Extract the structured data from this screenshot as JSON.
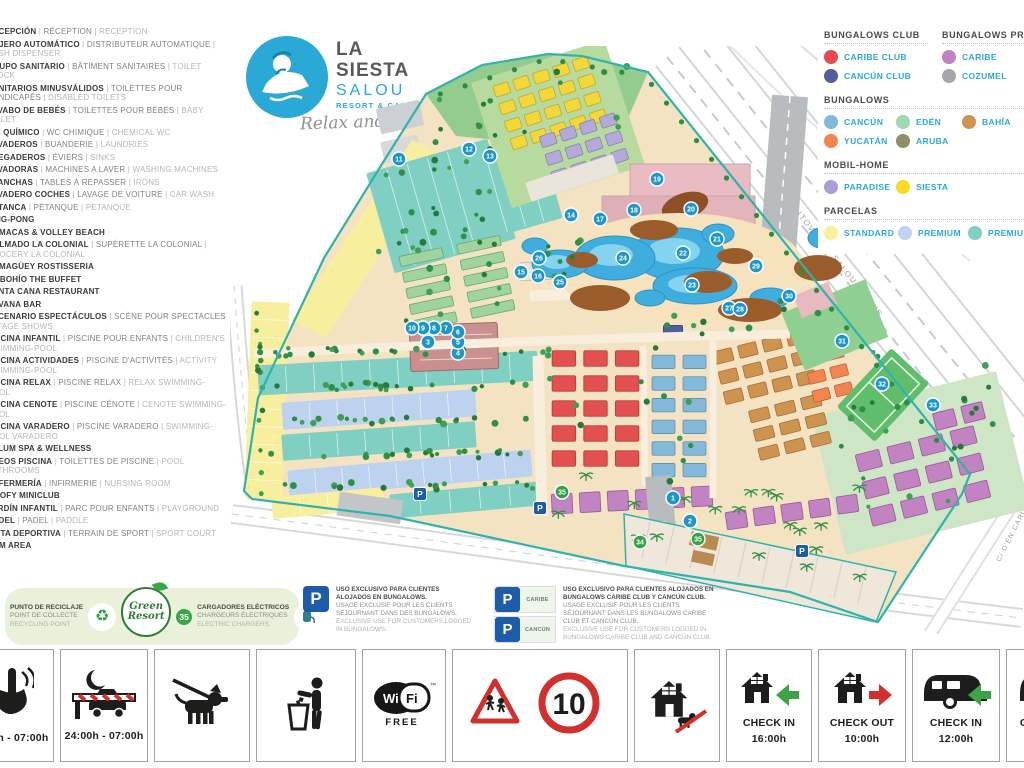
{
  "logo": {
    "line1": "LA",
    "line2": "SIESTA",
    "line3": "SALOU",
    "line4": "RESORT & CAMPING",
    "tagline": "Relax and Enjoy"
  },
  "sidebar": {
    "items": [
      {
        "es": "RECEPCIÓN",
        "fr": "RÉCEPTION",
        "en": "RECEPTION"
      },
      {
        "es": "CAJERO AUTOMÁTICO",
        "fr": "DISTRIBUTEUR AUTOMATIQUE",
        "en": "CASH DISPENSER"
      },
      {
        "es": "GRUPO SANITARIO",
        "fr": "BÂTIMENT SANITAIRES",
        "en": "TOILET BLOCK"
      },
      {
        "es": "SANITARIOS MINUSVÁLIDOS",
        "fr": "TOILETTES POUR HANDICAPÉS",
        "en": "DISABLED TOILETS"
      },
      {
        "es": "LAVABO DE BEBÉS",
        "fr": "TOILETTES POUR BÉBÉS",
        "en": "BABY TOILET"
      },
      {
        "es": "WC QUÍMICO",
        "fr": "WC CHIMIQUE",
        "en": "CHEMICAL WC"
      },
      {
        "es": "LAVADEROS",
        "fr": "BUANDERIE",
        "en": "LAUNDRIES"
      },
      {
        "es": "FREGADEROS",
        "fr": "ÉVIERS",
        "en": "SINKS"
      },
      {
        "es": "LAVADORAS",
        "fr": "MACHINES A LAVER",
        "en": "WASHING MACHINES"
      },
      {
        "es": "PLANCHAS",
        "fr": "TABLES À REPASSER",
        "en": "IRONS"
      },
      {
        "es": "LAVADERO COCHES",
        "fr": "LAVAGE DE VOITURE",
        "en": "CAR WASH"
      },
      {
        "es": "PETANCA",
        "fr": "PÉTANQUE",
        "en": "PETANQUE"
      },
      {
        "es": "PING-PONG"
      },
      {
        "es": "HAMACAS & VOLLEY BEACH"
      },
      {
        "es": "COLMADO LA COLONIAL",
        "fr": "SUPÉRETTE LA COLONIAL",
        "en": "GROCERY LA COLONIAL"
      },
      {
        "es": "CAMAGÜEY ROSTISSERIA"
      },
      {
        "es": "EL BOHÍO THE BUFFET"
      },
      {
        "es": "PUNTA CANA RESTAURANT"
      },
      {
        "es": "HAVANA BAR"
      },
      {
        "es": "ESCENARIO ESPECTÁCULOS",
        "fr": "SCÈNE POUR SPECTACLES",
        "en": "STAGE SHOWS"
      },
      {
        "es": "PISCINA INFANTIL",
        "fr": "PISCINE POUR ENFANTS",
        "en": "CHILDREN'S SWIMMING-POOL"
      },
      {
        "es": "PISCINA ACTIVIDADES",
        "fr": "PISCINE D'ACTIVITÉS",
        "en": "ACTIVITY SWIMMING-POOL"
      },
      {
        "es": "PISCINA RELAX",
        "fr": "PISCINE RELAX",
        "en": "RELAX SWIMMING-POOL"
      },
      {
        "es": "PISCINA CENOTE",
        "fr": "PISCINE CÉNOTE",
        "en": "CENOTE SWIMMING-POOL"
      },
      {
        "es": "PISCINA VARADERO",
        "fr": "PISCINE VARADERO",
        "en": "SWIMMING-POOL VARADERO"
      },
      {
        "es": "TULUM SPA & WELLNESS"
      },
      {
        "es": "ASEOS PISCINA",
        "fr": "TOILETTES DE PISCINE",
        "en": "POOL BATHROOMS"
      },
      {
        "es": "ENFERMERÍA",
        "fr": "INFIRMERIE",
        "en": "NURSING ROOM"
      },
      {
        "es": "GOOFY MINICLUB"
      },
      {
        "es": "JARDÍN INFANTIL",
        "fr": "PARC POUR ENFANTS",
        "en": "PLAYGROUND"
      },
      {
        "es": "PÁDEL",
        "fr": "PADEL",
        "en": "PADDLE"
      },
      {
        "es": "PISTA DEPORTIVA",
        "fr": "TERRAIN DE SPORT",
        "en": "SPORT COURT"
      },
      {
        "es": "GYM AREA"
      }
    ]
  },
  "legend": {
    "rows": [
      {
        "columns": [
          {
            "title": "BUNGALOWS CLUB",
            "items": [
              {
                "label": "CARIBE CLUB",
                "color": "#e8484e"
              },
              {
                "label": "CANCÚN CLUB",
                "color": "#4f5e9c"
              }
            ]
          },
          {
            "title": "BUNGALOWS PREMIUM",
            "items": [
              {
                "label": "CARIBE",
                "color": "#c27fc2"
              },
              {
                "label": "COZUMEL",
                "color": "#a7a3af"
              }
            ]
          }
        ]
      },
      {
        "columns": [
          {
            "title": "BUNGALOWS",
            "grid": "72px 66px auto",
            "items": [
              {
                "label": "CANCÚN",
                "color": "#7fb8d9"
              },
              {
                "label": "EDÉN",
                "color": "#9ed8b2"
              },
              {
                "label": "BAHÍA",
                "color": "#cf9350"
              },
              {
                "label": "YUCATÁN",
                "color": "#f2854f"
              },
              {
                "label": "ARUBA",
                "color": "#8f8f66"
              }
            ]
          }
        ]
      },
      {
        "columns": [
          {
            "title": "MOBIL-HOME",
            "grid": "72px 66px auto",
            "items": [
              {
                "label": "PARADISE",
                "color": "#a79fd6"
              },
              {
                "label": "SIESTA",
                "color": "#f8da22"
              }
            ]
          }
        ]
      },
      {
        "columns": [
          {
            "title": "PARCELAS",
            "grid": "74px 70px auto",
            "items": [
              {
                "label": "STANDARD",
                "color": "#f9f099"
              },
              {
                "label": "PREMIUM",
                "color": "#bdd2ef"
              },
              {
                "label": "PREMIUM PLUS",
                "color": "#7fcfc2"
              }
            ]
          }
        ]
      }
    ]
  },
  "map": {
    "streets": {
      "autovia": "AUTOVÍA DE SALOU A REUS",
      "berlin": "C/ DE BERLIN",
      "nord": "C/ DEL NORD",
      "carles": "C/ D'EN CARLES BUIGAS"
    },
    "markers": [
      {
        "n": "1",
        "t": "b",
        "x": 443,
        "y": 452
      },
      {
        "n": "2",
        "t": "b",
        "x": 460,
        "y": 475
      },
      {
        "n": "3",
        "t": "b",
        "x": 198,
        "y": 296
      },
      {
        "n": "4",
        "t": "b",
        "x": 228,
        "y": 307
      },
      {
        "n": "5",
        "t": "b",
        "x": 228,
        "y": 296
      },
      {
        "n": "6",
        "t": "b",
        "x": 228,
        "y": 286
      },
      {
        "n": "7",
        "t": "b",
        "x": 216,
        "y": 282
      },
      {
        "n": "8",
        "t": "b",
        "x": 204,
        "y": 282
      },
      {
        "n": "9",
        "t": "b",
        "x": 193,
        "y": 282
      },
      {
        "n": "10",
        "t": "b",
        "x": 182,
        "y": 282
      },
      {
        "n": "11",
        "t": "b",
        "x": 169,
        "y": 113
      },
      {
        "n": "12",
        "t": "b",
        "x": 239,
        "y": 103
      },
      {
        "n": "13",
        "t": "b",
        "x": 260,
        "y": 110
      },
      {
        "n": "14",
        "t": "b",
        "x": 341,
        "y": 169
      },
      {
        "n": "15",
        "t": "b",
        "x": 291,
        "y": 226
      },
      {
        "n": "16",
        "t": "b",
        "x": 308,
        "y": 230
      },
      {
        "n": "17",
        "t": "b",
        "x": 370,
        "y": 173
      },
      {
        "n": "18",
        "t": "b",
        "x": 404,
        "y": 164
      },
      {
        "n": "19",
        "t": "b",
        "x": 427,
        "y": 133
      },
      {
        "n": "20",
        "t": "b",
        "x": 461,
        "y": 163
      },
      {
        "n": "21",
        "t": "b",
        "x": 487,
        "y": 193
      },
      {
        "n": "22",
        "t": "b",
        "x": 453,
        "y": 207
      },
      {
        "n": "23",
        "t": "b",
        "x": 462,
        "y": 239
      },
      {
        "n": "24",
        "t": "b",
        "x": 393,
        "y": 212
      },
      {
        "n": "25",
        "t": "b",
        "x": 330,
        "y": 236
      },
      {
        "n": "26",
        "t": "b",
        "x": 309,
        "y": 212
      },
      {
        "n": "27",
        "t": "b",
        "x": 499,
        "y": 262
      },
      {
        "n": "28",
        "t": "b",
        "x": 510,
        "y": 263
      },
      {
        "n": "29",
        "t": "b",
        "x": 526,
        "y": 220
      },
      {
        "n": "30",
        "t": "b",
        "x": 559,
        "y": 250
      },
      {
        "n": "31",
        "t": "b",
        "x": 612,
        "y": 295
      },
      {
        "n": "32",
        "t": "b",
        "x": 652,
        "y": 338
      },
      {
        "n": "33",
        "t": "b",
        "x": 703,
        "y": 359
      },
      {
        "n": "34",
        "t": "g",
        "x": 410,
        "y": 496
      },
      {
        "n": "35",
        "t": "g",
        "x": 468,
        "y": 493
      },
      {
        "n": "35",
        "t": "g",
        "x": 332,
        "y": 446
      },
      {
        "n": "P",
        "t": "p",
        "x": 190,
        "y": 448
      },
      {
        "n": "P",
        "t": "p",
        "x": 310,
        "y": 462
      },
      {
        "n": "P",
        "t": "p",
        "x": 572,
        "y": 505
      }
    ],
    "zones": [
      {
        "t": "p",
        "d": "M196,48 L252,19 L318,8 L352,10 L418,26 L392,86 L300,97 L226,90 Z",
        "fill": "#94cb8e"
      },
      {
        "t": "r",
        "x": 148,
        "y": 58,
        "w": 44,
        "h": 26,
        "rot": -12,
        "fill": "#ccd0d4"
      },
      {
        "t": "r",
        "x": 152,
        "y": 92,
        "w": 38,
        "h": 22,
        "rot": -12,
        "fill": "#d9d9d5"
      },
      {
        "t": "p",
        "d": "M182,94 L214,108 L96,292 L62,274 Z",
        "fill": "#f7ef9e"
      },
      {
        "t": "pb",
        "x": 18,
        "y": 256,
        "w": 38,
        "h": 196,
        "rot": 2,
        "fill": "#f7ef9e",
        "divs": 11,
        "horiz": true
      },
      {
        "t": "pb",
        "x": 148,
        "y": 108,
        "w": 126,
        "h": 104,
        "rot": -16,
        "fill": "#7fcfc2",
        "divs": 6
      },
      {
        "t": "pb",
        "x": 246,
        "y": 96,
        "w": 76,
        "h": 88,
        "rot": -16,
        "fill": "#7fcfc2",
        "divs": 4
      },
      {
        "t": "g",
        "x": 168,
        "y": 196,
        "w": 118,
        "h": 82,
        "rot": -12,
        "rows": 5,
        "cols": 2,
        "fill": "#9fd3a0",
        "stroke": "#6aa86c"
      },
      {
        "t": "r",
        "x": 258,
        "y": 12,
        "w": 140,
        "h": 132,
        "rot": -18,
        "fill": "#b7da9e"
      },
      {
        "t": "g",
        "x": 268,
        "y": 20,
        "w": 104,
        "h": 74,
        "rot": -18,
        "rows": 4,
        "cols": 5,
        "fill": "#f3d83a",
        "stroke": "#c9a42c"
      },
      {
        "t": "g",
        "x": 312,
        "y": 74,
        "w": 84,
        "h": 56,
        "rot": -18,
        "rows": 3,
        "cols": 4,
        "fill": "#b3aad9",
        "stroke": "#8a7fb8"
      },
      {
        "t": "r",
        "x": 296,
        "y": 122,
        "w": 92,
        "h": 20,
        "rot": -18,
        "fill": "#e9e5da"
      },
      {
        "t": "pb",
        "x": 28,
        "y": 312,
        "w": 280,
        "h": 30,
        "rot": -3,
        "fill": "#7fcfc2",
        "divs": 10
      },
      {
        "t": "pb",
        "x": 52,
        "y": 350,
        "w": 194,
        "h": 27,
        "rot": -4,
        "fill": "#bdd2ef",
        "divs": 7
      },
      {
        "t": "pb",
        "x": 52,
        "y": 382,
        "w": 194,
        "h": 26,
        "rot": -4,
        "fill": "#7fcfc2",
        "divs": 7
      },
      {
        "t": "pb",
        "x": 58,
        "y": 414,
        "w": 244,
        "h": 27,
        "rot": -5,
        "fill": "#bdd2ef",
        "divs": 9
      },
      {
        "t": "pb",
        "x": 42,
        "y": 446,
        "w": 112,
        "h": 22,
        "rot": -5,
        "fill": "#f7ef9e",
        "divs": 4
      },
      {
        "t": "pb",
        "x": 160,
        "y": 442,
        "w": 150,
        "h": 24,
        "rot": -5,
        "fill": "#7fcfc2",
        "divs": 5
      },
      {
        "t": "r",
        "x": 596,
        "y": 346,
        "w": 190,
        "h": 142,
        "rot": -14,
        "fill": "#cfe6c6"
      },
      {
        "t": "g",
        "x": 318,
        "y": 300,
        "w": 95,
        "h": 125,
        "rot": 0,
        "rows": 5,
        "cols": 3,
        "fill": "#e2504f",
        "stroke": "#b23535"
      },
      {
        "t": "g",
        "x": 418,
        "y": 305,
        "w": 62,
        "h": 130,
        "rot": 0,
        "rows": 6,
        "cols": 2,
        "fill": "#85b9d9",
        "stroke": "#5a8fb5"
      },
      {
        "t": "g",
        "x": 430,
        "y": 252,
        "w": 26,
        "h": 46,
        "rot": 0,
        "rows": 2,
        "cols": 1,
        "fill": "#4f5e9c",
        "stroke": "#38457a"
      },
      {
        "t": "g",
        "x": 485,
        "y": 290,
        "w": 100,
        "h": 62,
        "rot": -14,
        "rows": 3,
        "cols": 4,
        "fill": "#cf9350",
        "stroke": "#a56f34"
      },
      {
        "t": "g",
        "x": 520,
        "y": 352,
        "w": 80,
        "h": 58,
        "rot": -14,
        "rows": 3,
        "cols": 3,
        "fill": "#cf9350",
        "stroke": "#a56f34"
      },
      {
        "t": "g",
        "x": 575,
        "y": 300,
        "w": 46,
        "h": 56,
        "rot": -14,
        "rows": 3,
        "cols": 2,
        "fill": "#f2854f",
        "stroke": "#c65f30"
      },
      {
        "t": "g",
        "x": 318,
        "y": 438,
        "w": 168,
        "h": 32,
        "rot": -3,
        "rows": 1,
        "cols": 6,
        "fill": "#c183c1",
        "stroke": "#96599a"
      },
      {
        "t": "g",
        "x": 492,
        "y": 452,
        "w": 140,
        "h": 28,
        "rot": -8,
        "rows": 1,
        "cols": 5,
        "fill": "#c183c1",
        "stroke": "#96599a"
      },
      {
        "t": "g",
        "x": 628,
        "y": 388,
        "w": 130,
        "h": 84,
        "rot": -14,
        "rows": 3,
        "cols": 4,
        "fill": "#c183c1",
        "stroke": "#96599a"
      },
      {
        "t": "g",
        "x": 700,
        "y": 356,
        "w": 58,
        "h": 28,
        "rot": -14,
        "rows": 1,
        "cols": 2,
        "fill": "#c183c1",
        "stroke": "#96599a"
      },
      {
        "t": "r",
        "x": 180,
        "y": 278,
        "w": 88,
        "h": 46,
        "rot": -2,
        "fill": "#c99090",
        "stroke": "#a06a6a"
      },
      {
        "t": "r",
        "x": 290,
        "y": 216,
        "w": 32,
        "h": 18,
        "rot": -3,
        "fill": "#eae4d6",
        "stroke": "#c9c2b0"
      }
    ],
    "tree_strips": [
      {
        "x": 30,
        "y": 302,
        "w": 290,
        "h": 8,
        "n": 24
      },
      {
        "x": 30,
        "y": 336,
        "w": 270,
        "h": 8,
        "n": 22
      },
      {
        "x": 30,
        "y": 370,
        "w": 270,
        "h": 8,
        "n": 22
      },
      {
        "x": 35,
        "y": 404,
        "w": 265,
        "h": 8,
        "n": 20
      },
      {
        "x": 40,
        "y": 436,
        "w": 265,
        "h": 8,
        "n": 18
      },
      {
        "x": 22,
        "y": 260,
        "w": 12,
        "h": 190,
        "n": 13
      },
      {
        "x": 148,
        "y": 108,
        "w": 126,
        "h": 104,
        "n": 16
      },
      {
        "x": 168,
        "y": 196,
        "w": 118,
        "h": 82,
        "n": 12
      },
      {
        "x": 255,
        "y": 15,
        "w": 145,
        "h": 75,
        "n": 9
      },
      {
        "x": 200,
        "y": 48,
        "w": 55,
        "h": 40,
        "n": 5
      },
      {
        "x": 300,
        "y": 170,
        "w": 80,
        "h": 60,
        "n": 8
      },
      {
        "x": 430,
        "y": 255,
        "w": 170,
        "h": 38,
        "n": 10
      },
      {
        "x": 598,
        "y": 350,
        "w": 170,
        "h": 125,
        "n": 15
      },
      {
        "x": 316,
        "y": 296,
        "w": 160,
        "h": 140,
        "n": 12
      },
      {
        "x": 300,
        "y": 430,
        "w": 330,
        "h": 42,
        "n": 10,
        "palm": 1
      },
      {
        "x": 405,
        "y": 478,
        "w": 250,
        "h": 64,
        "n": 9,
        "palm": 1
      },
      {
        "x": 640,
        "y": 300,
        "w": 120,
        "h": 58,
        "n": 8
      },
      {
        "x": 200,
        "y": 92,
        "w": 60,
        "h": 88,
        "n": 8
      }
    ]
  },
  "parking_legend": {
    "general": {
      "es": "USO EXCLUSIVO PARA CLIENTES ALOJADOS EN BUNGALOWS.",
      "fr": "USAGE EXCLUSIF POUR LES CLIENTS SÉJOURNANT DANS DES BUNGALOWS.",
      "en": "EXCLUSIVE USE FOR CUSTOMERS LODGED IN BUNGALOWS."
    },
    "club": {
      "signs": [
        "CARIBE",
        "CANCÚN"
      ],
      "es": "USO EXCLUSIVO PARA CLIENTES ALOJADOS EN BUNGALOWS CARIBE CLUB Y CANCÚN CLUB.",
      "fr": "USAGE EXCLUSIF POUR LES CLIENTS SÉJOURNANT DANS LES BUNGALOWS CARIBE CLUB ET CANCÚN CLUB.",
      "en": "EXCLUSIVE USE FOR CUSTOMERS LODGED IN BUNGALOWS CARIBE CLUB AND CANCÚN CLUB."
    }
  },
  "green_banner": {
    "recycle": {
      "es": "PUNTO DE RECICLAJE",
      "fr": "POINT DE COLLECTE",
      "en": "RECYCLING POINT"
    },
    "brand": {
      "top": "Green",
      "bottom": "Resort"
    },
    "chargers": {
      "count": "35",
      "es": "CARGADORES ELÉCTRICOS",
      "fr": "CHARGEURS ÉLECTRIQUES",
      "en": "ELECTRIC CHARGERS"
    }
  },
  "bottom_tiles": [
    {
      "icon": "silence",
      "label": "24:00h - 07:00h"
    },
    {
      "icon": "barrier",
      "label": "24:00h - 07:00h"
    },
    {
      "icon": "dog-leash"
    },
    {
      "icon": "litter"
    },
    {
      "icon": "wifi",
      "text": "WiFi",
      "sub": "FREE",
      "tm": "™"
    },
    {
      "icon": "children-speed",
      "speed": "10"
    },
    {
      "icon": "house-no-dogs"
    },
    {
      "icon": "house-check-in",
      "line1": "CHECK IN",
      "line2": "16:00h"
    },
    {
      "icon": "house-check-out",
      "line1": "CHECK OUT",
      "line2": "10:00h"
    },
    {
      "icon": "caravan-check-in",
      "line1": "CHECK IN",
      "line2": "12:00h"
    },
    {
      "icon": "caravan-check-out",
      "line1": "CHECK OUT",
      "line2": "12:00h"
    }
  ]
}
